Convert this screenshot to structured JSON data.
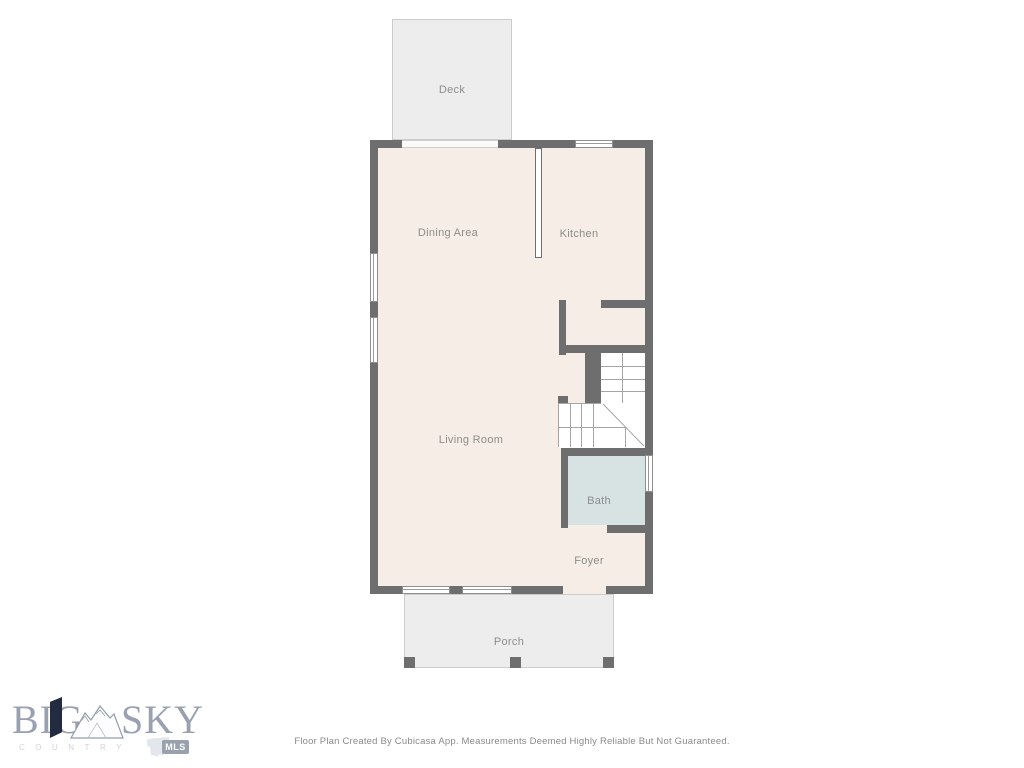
{
  "rooms": {
    "deck": "Deck",
    "dining": "Dining Area",
    "kitchen": "Kitchen",
    "living": "Living Room",
    "bath": "Bath",
    "foyer": "Foyer",
    "porch": "Porch"
  },
  "logo": {
    "word_big": "BIG",
    "word_sky": "SKY",
    "subtitle": "COUNTRY",
    "badge": "MLS"
  },
  "footer": {
    "text": "Floor Plan Created By Cubicasa App. Measurements Deemed Highly Reliable But Not Guaranteed."
  },
  "colors": {
    "wall": "#6e6e6e",
    "floor": "#f5ede6",
    "outdoor": "#ededed",
    "bath_fill": "#d7e3e3",
    "label_text": "#8d8d8d",
    "logo_gray": "#99a1b0",
    "logo_navy": "#232b40",
    "badge_bg": "#99a1ad"
  }
}
